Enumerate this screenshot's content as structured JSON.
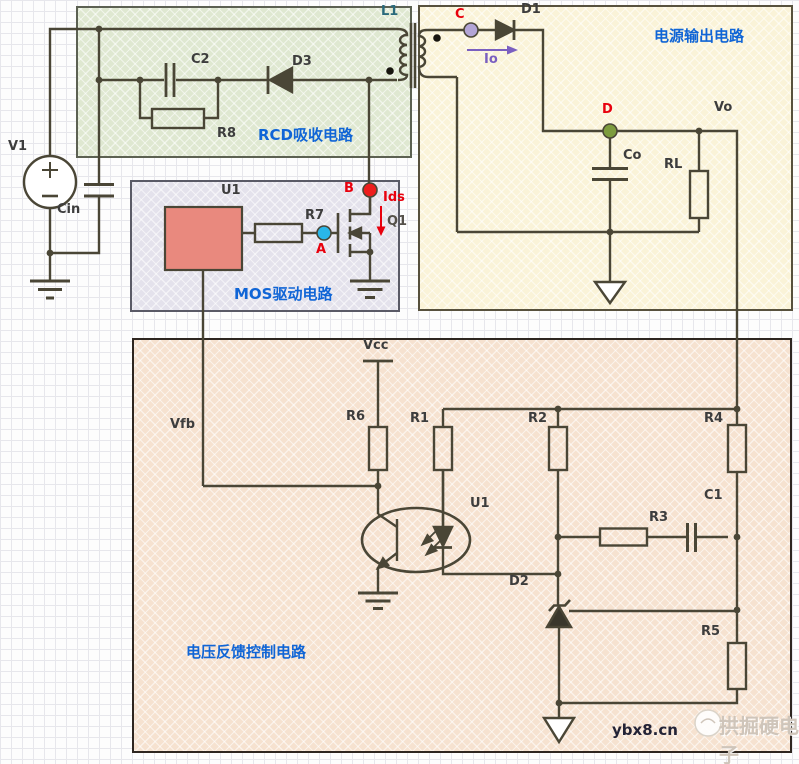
{
  "regions": {
    "rcd": "RCD吸收电路",
    "output": "电源输出电路",
    "mos": "MOS驱动电路",
    "feedback": "电压反馈控制电路"
  },
  "components": {
    "v1": "V1",
    "cin": "Cin",
    "c2": "C2",
    "r8": "R8",
    "d3": "D3",
    "l1": "L1",
    "d1": "D1",
    "co": "Co",
    "rl": "RL",
    "u1_driver": "U1",
    "r7": "R7",
    "q1": "Q1",
    "u1_opto": "U1",
    "r6": "R6",
    "r1": "R1",
    "r2": "R2",
    "r3": "R3",
    "r4": "R4",
    "r5": "R5",
    "c1": "C1",
    "d2": "D2"
  },
  "nets": {
    "vo": "Vo",
    "vcc": "Vcc",
    "vfb": "Vfb"
  },
  "nodes": {
    "a": "A",
    "b": "B",
    "c": "C",
    "d": "D"
  },
  "currents": {
    "io": "Io",
    "ids": "Ids"
  },
  "watermark": {
    "site": "ybx8.cn",
    "brand": "拱掘硬电子"
  },
  "colors": {
    "wire": "#4a4636",
    "label": "#3d3d3d",
    "section_label": "#1065d6",
    "marker_red": "#e8000d",
    "node_a": "#29b7ea",
    "node_b": "#ee1d1d",
    "node_c": "#b3a5d6",
    "node_d": "#7d9c3e",
    "io_arrow": "#7a5fc0",
    "u1_driver_fill": "#e9897e",
    "region_rcd": "#dfe8d1",
    "region_output": "#faf3d8",
    "region_mos": "#e4e2ec",
    "region_feedback": "#f6e2d0"
  }
}
